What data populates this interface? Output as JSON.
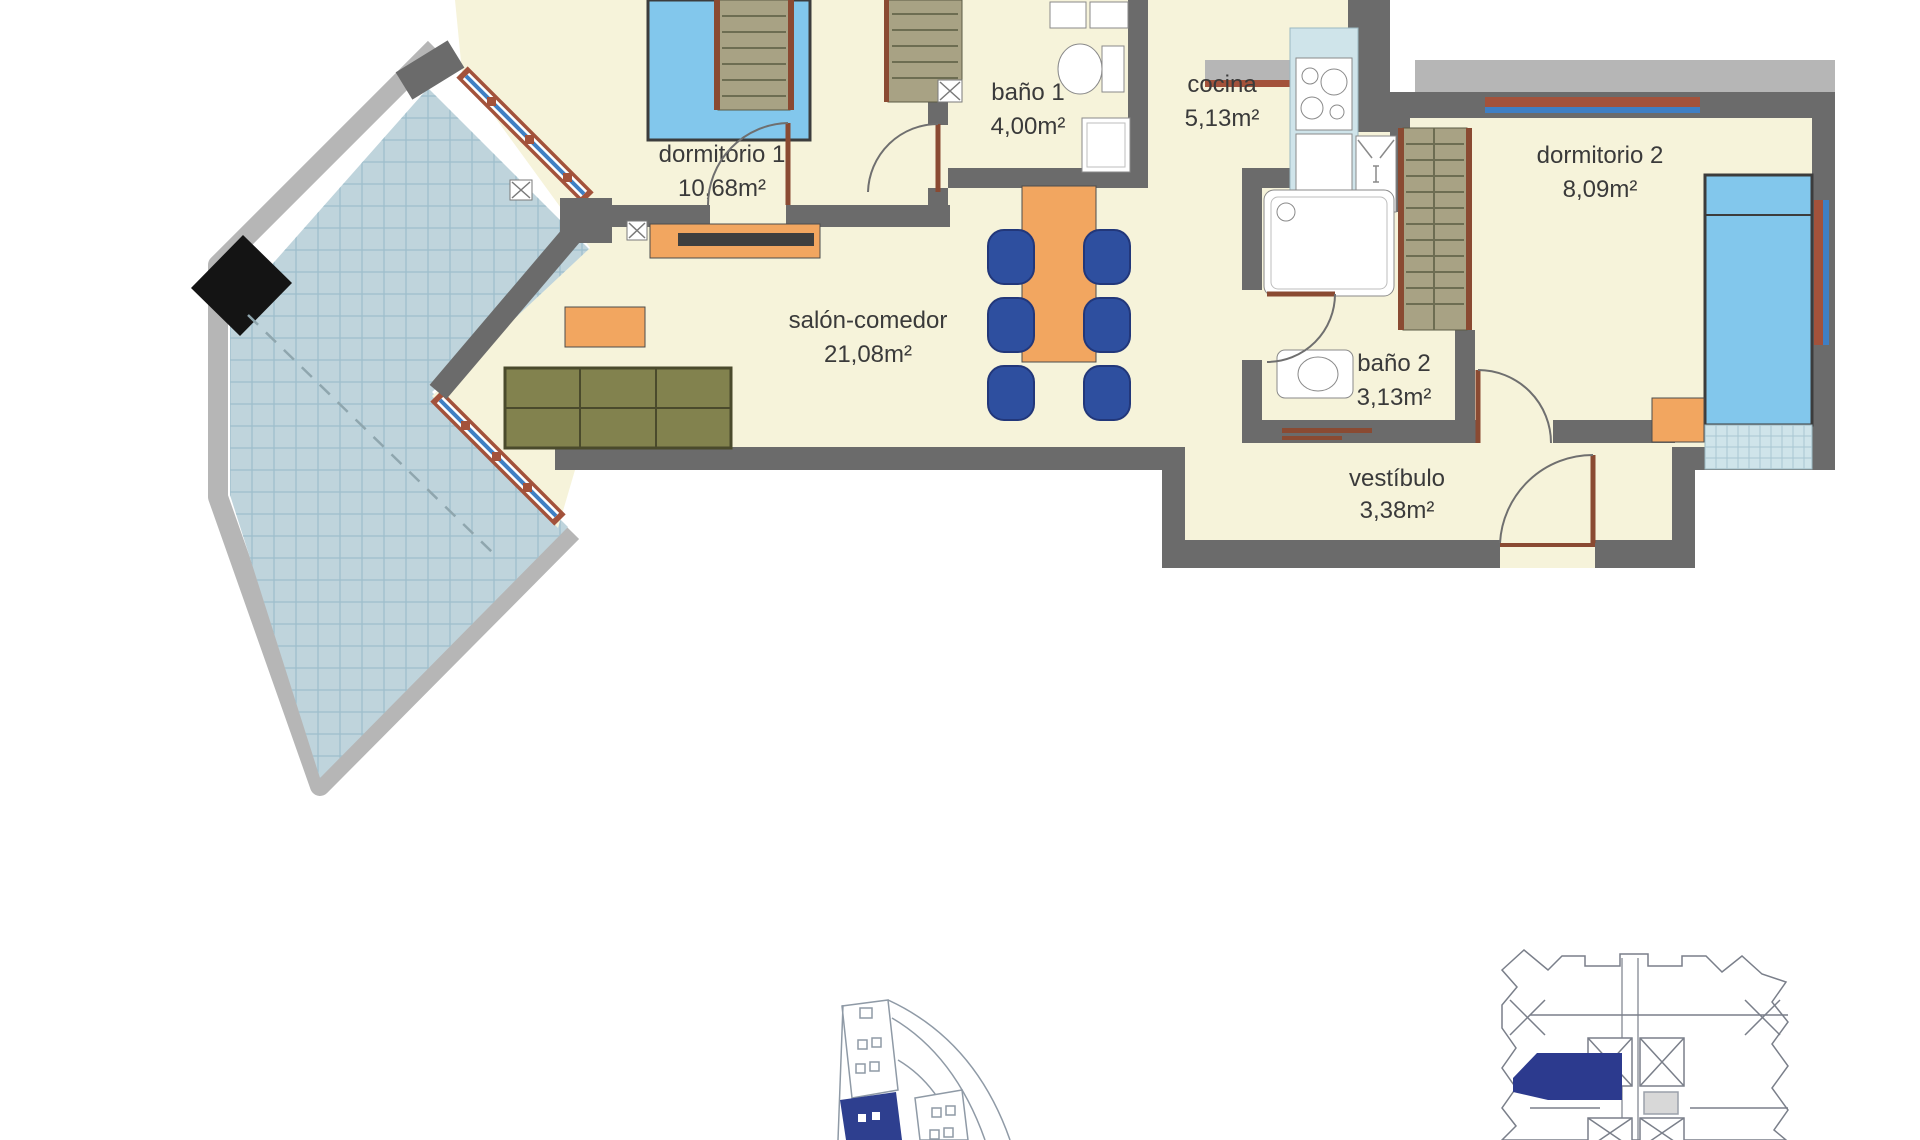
{
  "floor_plan": {
    "rooms": [
      {
        "id": "dormitorio-1",
        "name": "dormitorio 1",
        "area": "10,68m²"
      },
      {
        "id": "bano-1",
        "name": "baño 1",
        "area": "4,00m²"
      },
      {
        "id": "cocina",
        "name": "cocina",
        "area": "5,13m²"
      },
      {
        "id": "dormitorio-2",
        "name": "dormitorio 2",
        "area": "8,09m²"
      },
      {
        "id": "salon-comedor",
        "name": "salón-comedor",
        "area": "21,08m²"
      },
      {
        "id": "bano-2",
        "name": "baño 2",
        "area": "3,13m²"
      },
      {
        "id": "vestibulo",
        "name": "vestíbulo",
        "area": "3,38m²"
      }
    ],
    "colors": {
      "wall_dark": "#6b6b6b",
      "wall_light": "#b6b6b6",
      "floor_cream": "#f6f3da",
      "terrace_tile": "#bfd4dc",
      "window_glass": "#3f7fc4",
      "window_frame": "#a3523b",
      "furniture_orange": "#f2a660",
      "bed_blue": "#82c7ec",
      "chair_blue": "#2e4f9f",
      "sofa_olive": "#82824e",
      "unit_highlight_blue": "#2e3f8f"
    }
  }
}
